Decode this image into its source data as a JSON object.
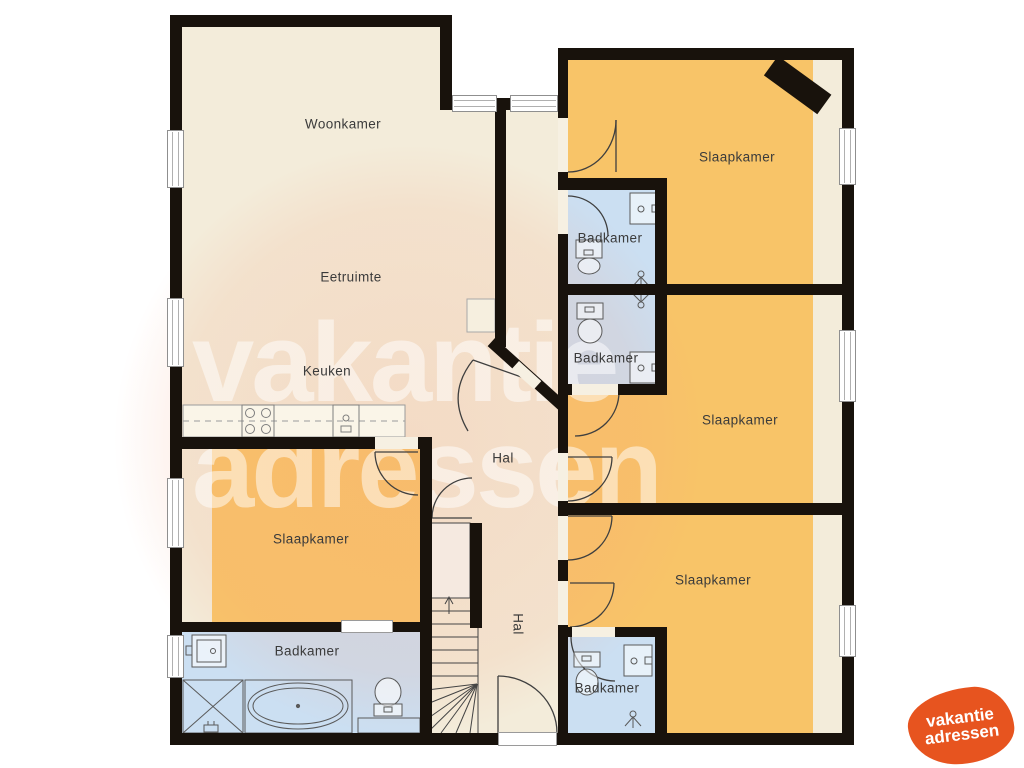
{
  "rooms": {
    "woonkamer": "Woonkamer",
    "eetruimte": "Eetruimte",
    "keuken": "Keuken",
    "hal": "Hal",
    "hal2": "Hal",
    "slaapkamer_tr": "Slaapkamer",
    "slaapkamer_mr": "Slaapkamer",
    "slaapkamer_br": "Slaapkamer",
    "slaapkamer_bl": "Slaapkamer",
    "badkamer_tr": "Badkamer",
    "badkamer_mr": "Badkamer",
    "badkamer_br": "Badkamer",
    "badkamer_bl": "Badkamer"
  },
  "watermark": {
    "line1": "vakantie",
    "line2": "adressen"
  },
  "logo": {
    "line1": "vakantie",
    "line2": "adressen"
  },
  "colors": {
    "wall": "#18120c",
    "floor": "#f3ecda",
    "bedroom": "#f8c468",
    "bathroom": "#cbdff2",
    "logo_orange": "#e7541f"
  }
}
